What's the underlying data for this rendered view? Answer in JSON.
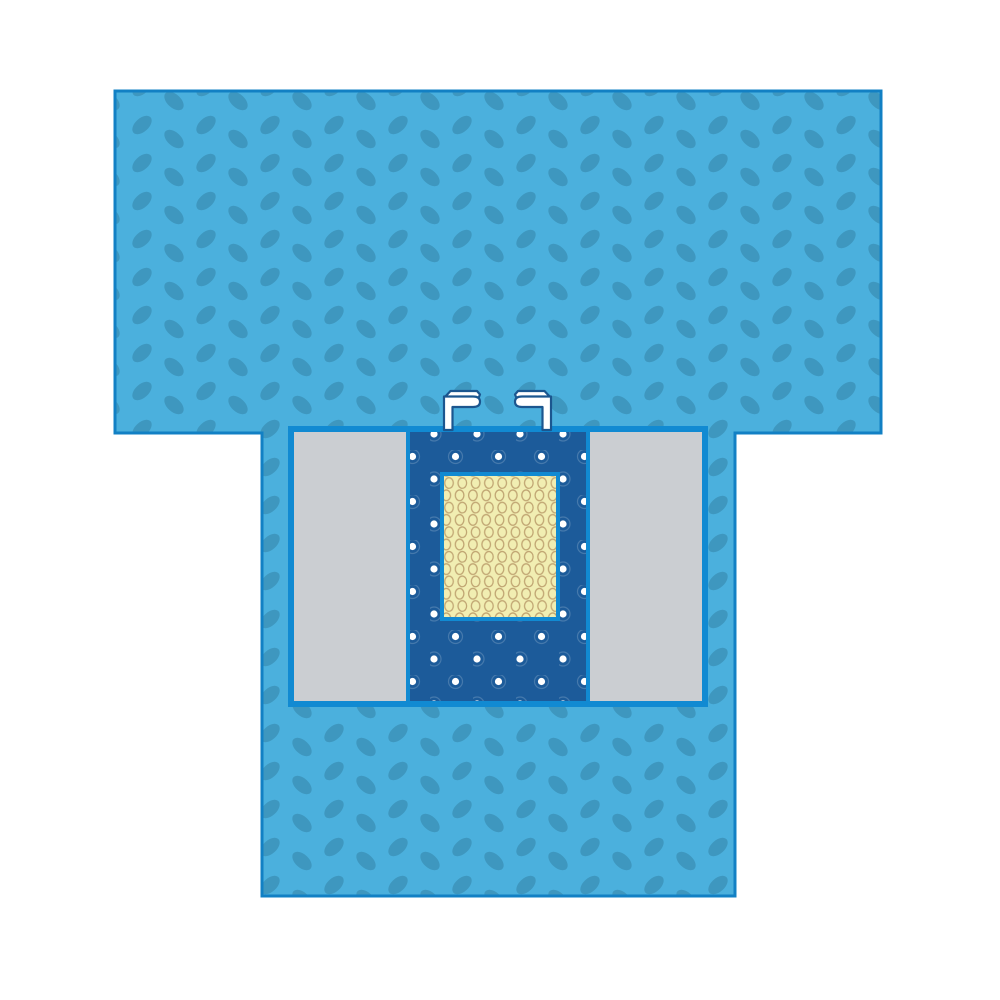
{
  "image": {
    "type": "product-illustration",
    "subject": "T-shaped surgical incise drape with reinforcement strip, side panels, fenestration film window and tube holder tabs",
    "background": "#ffffff"
  },
  "colors": {
    "fabric_base": "#4bb0dd",
    "fabric_oval": "#3e97bf",
    "drape_outline": "#1280c4",
    "strip_border": "#118ad2",
    "incise_panel": "#1c5b9a",
    "incise_dot": "#ffffff",
    "incise_dot_ring": "rgba(255,255,255,0.18)",
    "side_panel": "#cbced2",
    "window_fill": "#f1eeb2",
    "window_ring": "#c0a572",
    "holder_fill": "#ffffff",
    "holder_outline": "#1b568f"
  },
  "parts": {
    "drape_body": "drape-fabric",
    "reinforcement_strip": "reinforcement-strip",
    "side_panel_left": "side-panel-left",
    "side_panel_right": "side-panel-right",
    "incise_panel": "incise-panel",
    "incise_window": "incise-film-window",
    "tube_holder_left": "tube-holder-left",
    "tube_holder_right": "tube-holder-right"
  }
}
